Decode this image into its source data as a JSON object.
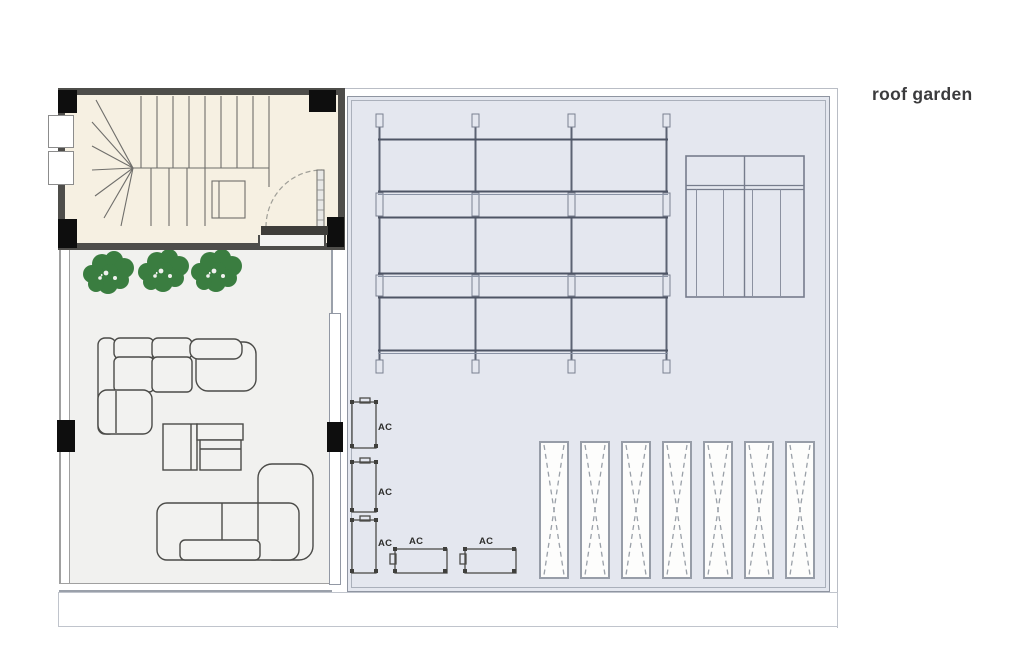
{
  "title": {
    "label": "roof garden"
  },
  "ac_units": {
    "items": [
      {
        "label": "AC"
      },
      {
        "label": "AC"
      },
      {
        "label": "AC"
      },
      {
        "label": "AC"
      },
      {
        "label": "AC"
      }
    ]
  },
  "structures": {
    "pergola": {
      "posts": 4,
      "beam_rows": 3
    },
    "louver_panel_count": 7,
    "plant_cluster_count": 3
  },
  "colors": {
    "roof_fill": "#e4e7ef",
    "terrace_fill": "#f1f1ef",
    "stairwell_fill": "#f6f0e2",
    "wall_dark": "#4e4d4a",
    "plant_green": "#3a7d40",
    "title_text": "#3b3b3d"
  }
}
